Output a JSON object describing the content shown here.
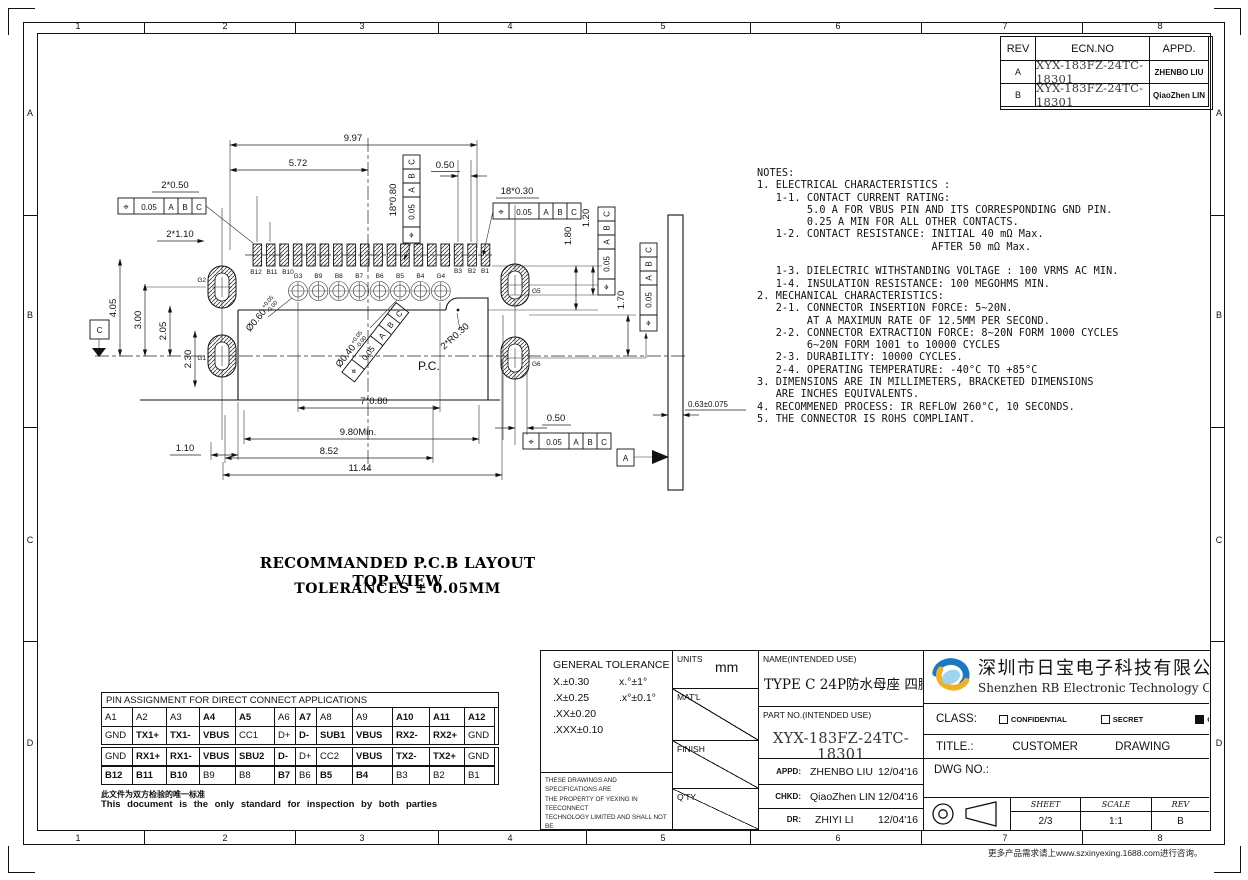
{
  "frame": {
    "zone_cols": [
      "1",
      "2",
      "3",
      "4",
      "5",
      "6",
      "7",
      "8"
    ],
    "zone_rows": [
      "A",
      "B",
      "C",
      "D"
    ]
  },
  "revision_table": {
    "col_rev": "REV",
    "col_ecn": "ECN.NO",
    "col_appd": "APPD.",
    "rows": [
      {
        "rev": "A",
        "ecn": "XYX-183FZ-24TC-18301",
        "appd": "ZHENBO LIU"
      },
      {
        "rev": "B",
        "ecn": "XYX-183FZ-24TC-18301",
        "appd": "QiaoZhen LIN"
      }
    ]
  },
  "notes": "NOTES:\n1. ELECTRICAL CHARACTERISTICS :\n   1-1. CONTACT CURRENT RATING:\n        5.0 A FOR VBUS PIN AND ITS CORRESPONDING GND PIN.\n        0.25 A MIN FOR ALL OTHER CONTACTS.\n   1-2. CONTACT RESISTANCE: INITIAL 40 mΩ Max.\n                            AFTER 50 mΩ Max.\n\n   1-3. DIELECTRIC WITHSTANDING VOLTAGE : 100 VRMS AC MIN.\n   1-4. INSULATION RESISTANCE: 100 MEGOHMS MIN.\n2. MECHANICAL CHARACTERISTICS:\n   2-1. CONNECTOR INSERTION FORCE: 5~20N.\n        AT A MAXIMUN RATE OF 12.5MM PER SECOND.\n   2-2. CONNECTOR EXTRACTION FORCE: 8~20N FORM 1000 CYCLES\n        6~20N FORM 1001 to 10000 CYCLES\n   2-3. DURABILITY: 10000 CYCLES.\n   2-4. OPERATING TEMPERATURE: -40°C TO +85°C\n3. DIMENSIONS ARE IN MILLIMETERS, BRACKETED DIMENSIONS\n   ARE INCHES EQUIVALENTS.\n4. RECOMMENED PROCESS: IR REFLOW 260°C, 10 SECONDS.\n5. THE CONNECTOR IS ROHS COMPLIANT.",
  "drawing": {
    "caption_line1": "RECOMMANDED P.C.B LAYOUT TOP VIEW",
    "caption_line2": "TOLERANCES ± 0.05MM",
    "pc_label": "P.C.",
    "datum_a": "A",
    "datum_c": "C",
    "fcf": {
      "sym": "⌖",
      "tol": "0.05",
      "a": "A",
      "b": "B",
      "c": "C"
    },
    "dims": {
      "w997": "9.97",
      "w572": "5.72",
      "w050t": "0.50",
      "p2x050": "2*0.50",
      "p2x110": "2*1.10",
      "p18x080": "18*0.80",
      "p18x030": "18*0.30",
      "h180": "1.80",
      "h120": "1.20",
      "h170": "1.70",
      "h405": "4.05",
      "h300": "3.00",
      "h205": "2.05",
      "h230": "2.30",
      "p7x080": "7*0.80",
      "w980": "9.80Min.",
      "w852": "8.52",
      "w1144": "11.44",
      "w110": "1.10",
      "w050b": "0.50",
      "t063": "0.63±0.075",
      "r2x030": "2*R0.30",
      "dia060": "Ø0.60",
      "dia040": "Ø0.40",
      "tol_plus": "+0.05",
      "tol_minus": "-0.00"
    },
    "pad_labels_left": [
      "B12",
      "B11",
      "B10"
    ],
    "pad_labels_right": [
      "B3",
      "B2",
      "B1"
    ],
    "hole_labels": [
      "G3",
      "B9",
      "B8",
      "B7",
      "B6",
      "B5",
      "B4",
      "G4"
    ],
    "slot_labels": {
      "g1": "G1",
      "g2": "G2",
      "g5": "G5",
      "g6": "G6"
    }
  },
  "pin_table": {
    "title": "PIN ASSIGNMENT FOR DIRECT CONNECT APPLICATIONS",
    "rows": [
      [
        "A1",
        "A2",
        "A3",
        "A4",
        "A5",
        "A6",
        "A7",
        "A8",
        "A9",
        "A10",
        "A11",
        "A12"
      ],
      [
        "GND",
        "TX1+",
        "TX1-",
        "VBUS",
        "CC1",
        "D+",
        "D-",
        "SUB1",
        "VBUS",
        "RX2-",
        "RX2+",
        "GND"
      ],
      [
        "GND",
        "RX1+",
        "RX1-",
        "VBUS",
        "SBU2",
        "D-",
        "D+",
        "CC2",
        "VBUS",
        "TX2-",
        "TX2+",
        "GND"
      ],
      [
        "B12",
        "B11",
        "B10",
        "B9",
        "B8",
        "B7",
        "B6",
        "B5",
        "B4",
        "B3",
        "B2",
        "B1"
      ]
    ],
    "note_cn": "此文件为双方检验的唯一标准",
    "note_en": "This document is the only standard for inspection by both parties"
  },
  "title_block": {
    "gt_title": "GENERAL TOLERANCE",
    "gt_r1l": "X.±0.30",
    "gt_r1r": "x.°±1°",
    "gt_r2l": ".X±0.25",
    "gt_r2r": ".x°±0.1°",
    "gt_r3l": ".XX±0.20",
    "gt_r4l": ".XXX±0.10",
    "legal": "THESE DRAWINGS AND SPECIFICATIONS ARE\nTHE PROPERTY OF YEXING IN TEECONNECT\nTECHNOLOGY LIMITED AND SHALL NOT BE\nREPRODUCED COPIED OR USED IN ANY MANNER\nWITHOUT THE PRIOR WRITTEN CONSENT OF\nXINYEXING INTERCONNETEC HNOLGY LIMITEDCT",
    "units_label": "UNITS",
    "units_value": "mm",
    "matl_label": "MAT'L",
    "finish_label": "FINISH",
    "qty_label": "Q'TY",
    "name_label": "NAME(INTENDED USE)",
    "name_value": "TYPE C 24P防水母座 四脚DIP",
    "part_label": "PART NO.(INTENDED USE)",
    "part_value": "XYX-183FZ-24TC-18301",
    "appd_label": "APPD:",
    "appd_value": "ZHENBO LIU",
    "appd_date": "12/04'16",
    "chkd_label": "CHKD:",
    "chkd_value": "QiaoZhen LIN",
    "chkd_date": "12/04'16",
    "dr_label": "DR:",
    "dr_value": "ZHIYI LI",
    "dr_date": "12/04'16",
    "company_cn": "深圳市日宝电子科技有限公司",
    "company_en": "Shenzhen RB Electronic Technology Co., Ltd.",
    "class_label": "CLASS:",
    "class_confidential": "CONFIDENTIAL",
    "class_secret": "SECRET",
    "class_general": "GENERAL",
    "title_label": "TITLE.:",
    "title_value": "CUSTOMER DRAWING",
    "dwg_label": "DWG NO.:",
    "sheet_label": "SHEET",
    "sheet_value": "2/3",
    "scale_label": "SCALE",
    "scale_value": "1:1",
    "rev_label": "REV",
    "rev_value": "B"
  },
  "footer": "更多产品需求请上www.szxinyexing.1688.com进行咨询。"
}
